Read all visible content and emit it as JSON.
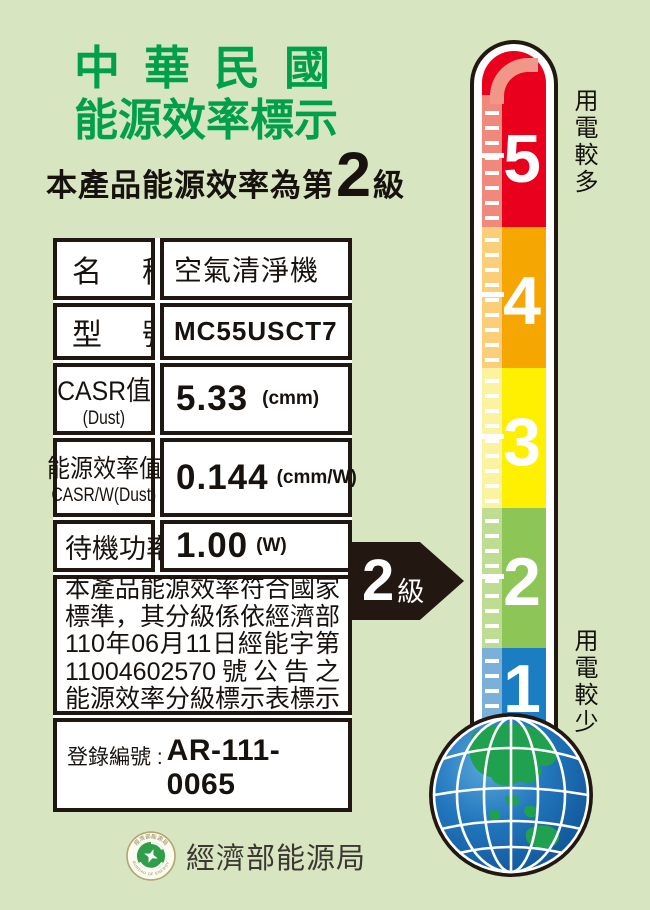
{
  "header": {
    "title_line1": "中華民國",
    "title_line2": "能源效率標示",
    "statement": {
      "prefix": "本產品能源效率為第",
      "grade": "2",
      "suffix": "級"
    }
  },
  "table": {
    "rows": [
      {
        "label": "名稱",
        "value": "空氣清淨機"
      },
      {
        "label": "型號",
        "value": "MC55USCT7"
      },
      {
        "label": "CASR值",
        "label_sub": "(Dust)",
        "value": "5.33",
        "unit": "(cmm)"
      },
      {
        "label": "能源效率值",
        "label_sub": "CASR/W(Dust)",
        "value": "0.144",
        "unit": "(cmm/W)"
      },
      {
        "label": "待機功率",
        "value": "1.00",
        "unit": "(W)"
      }
    ],
    "notice_lines": [
      "本產品能源效率符合國家",
      "標準，其分級係依經濟部",
      "110年06月11日經能字第",
      "11004602570號公告之",
      "能源效率分級標示表標示"
    ],
    "registration": {
      "label": "登錄編號 :",
      "number": "AR-111-0065"
    }
  },
  "grade_arrow": {
    "grade": "2",
    "suffix": "級"
  },
  "thermometer": {
    "top_label": "用電較多",
    "bottom_label": "用電較少",
    "levels": [
      {
        "value": "5",
        "color": "#e8001c",
        "tint": "#f0887c"
      },
      {
        "value": "4",
        "color": "#f6a600",
        "tint": "#fbcf79"
      },
      {
        "value": "3",
        "color": "#ffef00",
        "tint": "#fbf3a0"
      },
      {
        "value": "2",
        "color": "#8dc556",
        "tint": "#bedc92"
      },
      {
        "value": "1",
        "color": "#1b7ec2",
        "tint": "#7bb1d9"
      }
    ]
  },
  "footer": {
    "agency": "經濟部能源局",
    "logo_top_text": "經濟部能源局",
    "logo_bottom_text": "BUREAU OF ENERGY"
  },
  "colors": {
    "background": "#d8e5c1",
    "title_green": "#00a04a",
    "outline_black": "#231712",
    "table_bg": "#ffffff",
    "globe_ocean": "#1565ab",
    "globe_land": "#1fa14f"
  }
}
